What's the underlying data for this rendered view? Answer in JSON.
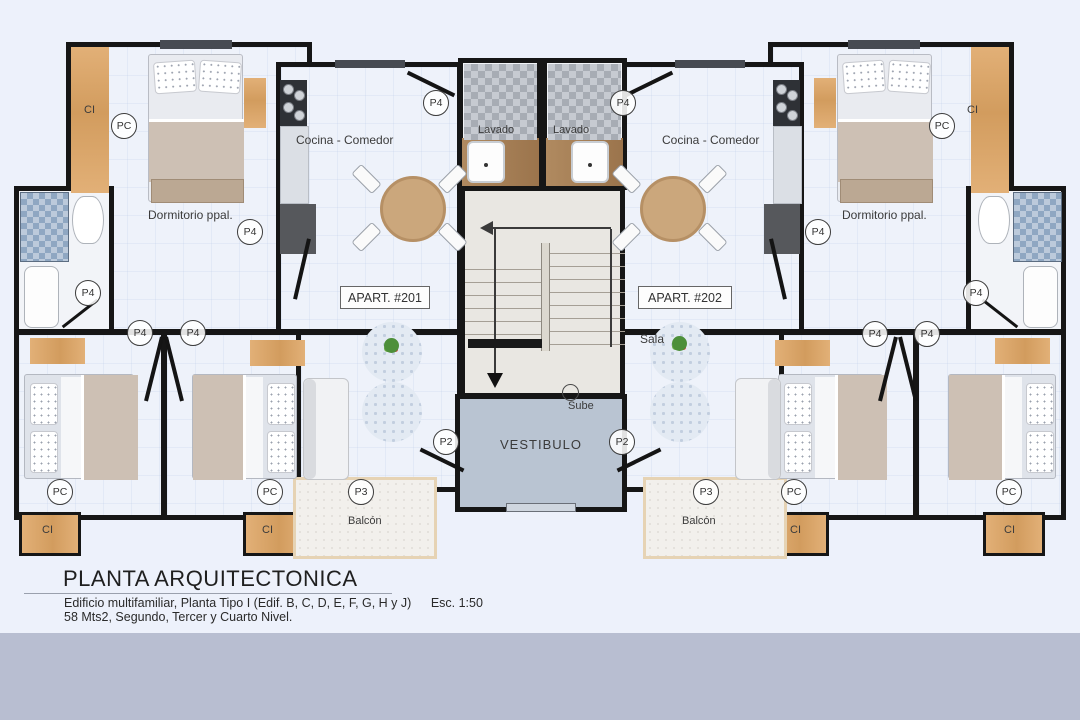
{
  "labels": {
    "cocina_comedor": "Cocina - Comedor",
    "lavado": "Lavado",
    "dormitorio_ppal": "Dormitorio ppal.",
    "sala": "Sala",
    "vestibulo": "VESTIBULO",
    "sube": "Sube",
    "balcon": "Balcón",
    "ci": "CI",
    "apart_left": "APART. #201",
    "apart_right": "APART. #202"
  },
  "door_tags": {
    "p2": "P2",
    "p3": "P3",
    "p4": "P4",
    "pc": "PC"
  },
  "title_block": {
    "title": "PLANTA ARQUITECTONICA",
    "subtitle": "Edificio multifamiliar, Planta Tipo I (Edif. B, C, D, E, F, G, H y J)",
    "scale": "Esc. 1:50",
    "details": "58 Mts2, Segundo, Tercer y Cuarto Nivel."
  },
  "colors": {
    "background": "#edf1fb",
    "footer_band": "#b8bed1",
    "wall": "#161616",
    "floor": "#eef2fa",
    "wood": "#d9a76b",
    "vestibule_floor": "#b9c4d2"
  }
}
